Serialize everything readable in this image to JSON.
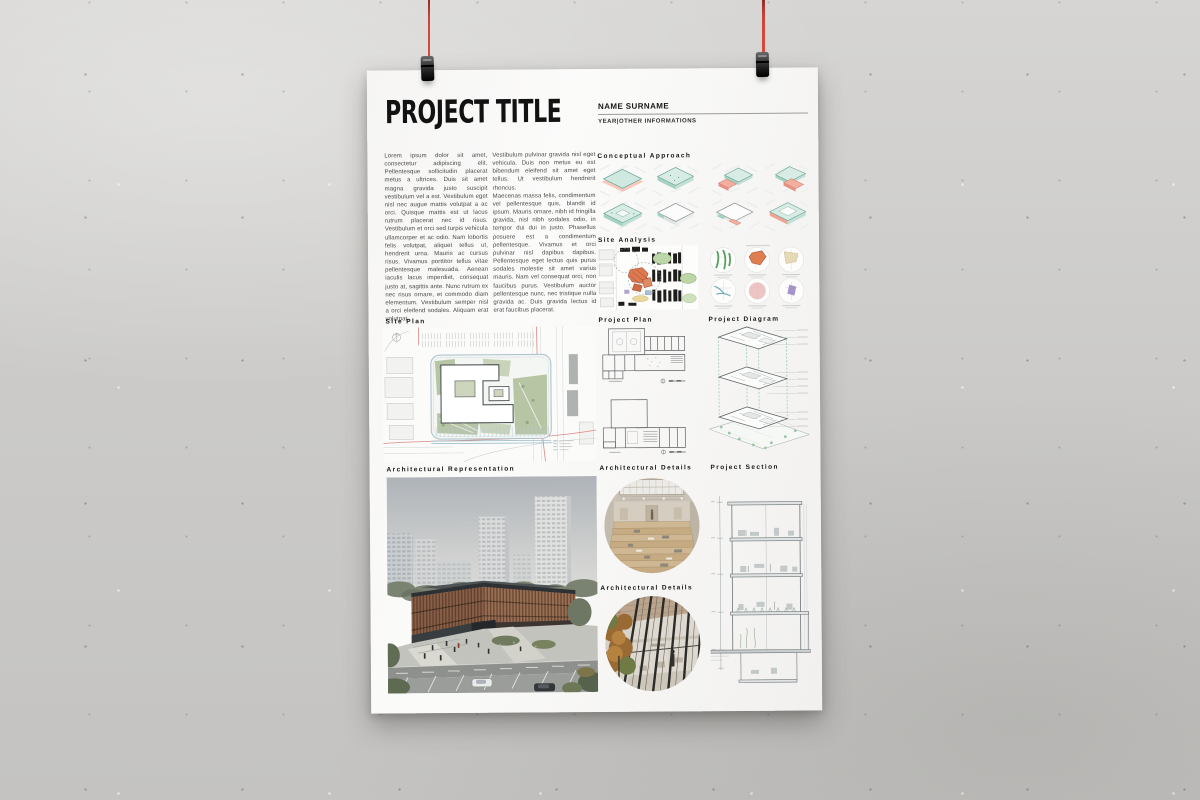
{
  "scene": {
    "hanging_string_color": "#cc4439",
    "clip_type": "binder-clip",
    "wall_color": "#cecdcb"
  },
  "poster": {
    "title": "PROJECT TITLE",
    "author": {
      "name": "NAME SURNAME",
      "meta": "YEAR|OTHER INFORMATIONS"
    },
    "intro": {
      "col1": "Lorem ipsum dolor sit amet, consectetur adipiscing elit. Pellentesque sollicitudin placerat metus a ultrices. Duis sit amet magna gravida justo suscipit vestibulum vel a est. Vestibulum eget nisl nec augue mattis volutpat a ac orci. Quisque mattis est ut lacus rutrum placerat nec id risus. Vestibulum et orci sed turpis vehicula ullamcorper et ac odio. Nam lobortis felis volutpat, aliquet tellus ut, hendrerit urna. Mauris ac cursus risus. Vivamus porttitor tellus vitae pellentesque malesuada. Aenean iaculis lacus imperdiet, consequat justo at, sagittis ante. Nunc rutrum ex nec risus ornare, et commodo diam elementum. Vestibulum semper nisl a orci eleifend sodales. Aliquam erat volutpat.",
      "col2": "Vestibulum pulvinar gravida nisl eget vehicula. Duis non metus eu est bibendum eleifend sit amet eget tellus. Ut vestibulum hendrerit rhoncus.\nMaecenas massa felis, condimentum vel pellentesque quis, blandit id ipsum. Mauris ornare, nibh id fringilla gravida, nisl nibh sodales odio, in tempor dui dui in justo. Phasellus posuere est a condimentum pellentesque. Vivamus et orci pulvinar nisl dapibus dapibus. Pellentesque eget lectus quis purus sodales molestie sit amet varius mauris. Nam vel consequat orci, non faucibus purus. Vestibulum auctor pellentesque nunc, nec tristique nulla gravida ac. Duis gravida lectus id erat faucibus placerat."
    },
    "sections": {
      "conceptual_approach": "Conceptual Approach",
      "site_analysis": "Site Analysis",
      "site_plan": "Site Plan",
      "project_plan": "Project Plan",
      "project_diagram": "Project Diagram",
      "architectural_representation": "Architectural Representation",
      "architectural_details_1": "Architectural Details",
      "architectural_details_2": "Architectural Details",
      "project_section": "Project Section"
    },
    "accent_colors": {
      "concept_teal": "#cfe9e1",
      "concept_salmon": "#f3b3a8",
      "analysis_green": "#5fa868",
      "analysis_orange": "#dd7d50",
      "analysis_beige": "#e6dab6",
      "analysis_teal": "#6fa9b8",
      "analysis_pink": "#e9b7b5",
      "analysis_purple": "#9d89c4"
    }
  }
}
